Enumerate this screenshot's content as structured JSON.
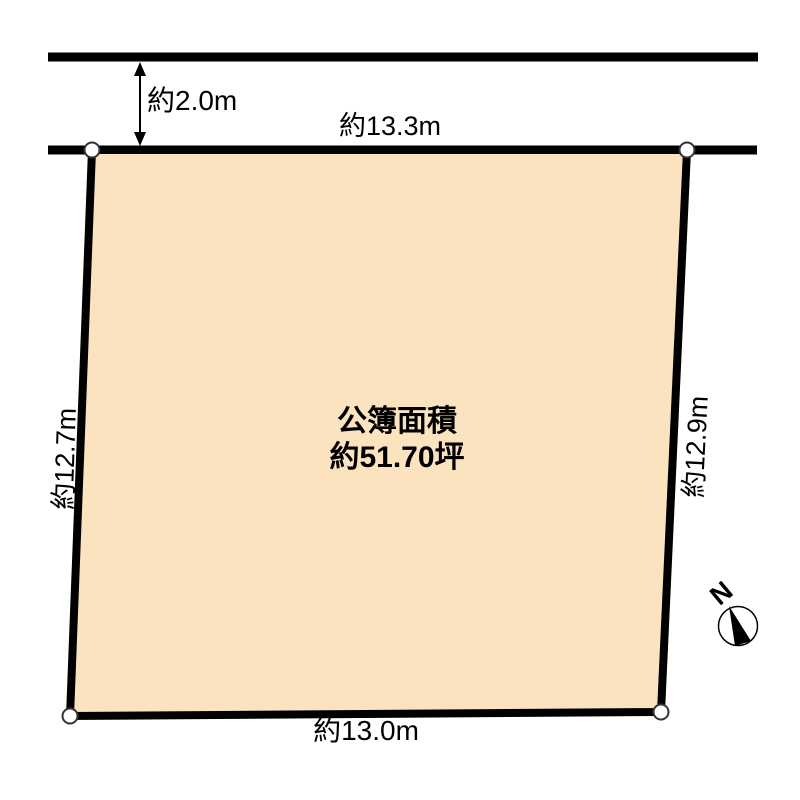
{
  "diagram": {
    "road": {
      "setback_label": "約2.0m"
    },
    "parcel": {
      "area_line1": "公簿面積",
      "area_line2": "約51.70坪"
    },
    "dimensions": {
      "top": "約13.3m",
      "left": "約12.7m",
      "right": "約12.9m",
      "bottom": "約13.0m"
    },
    "compass": {
      "label": "N"
    },
    "colors": {
      "parcel_fill": "#FBE3C0",
      "outline": "#000000",
      "corner_marker_fill": "#FFFFFF",
      "corner_marker_stroke": "#333333"
    }
  }
}
